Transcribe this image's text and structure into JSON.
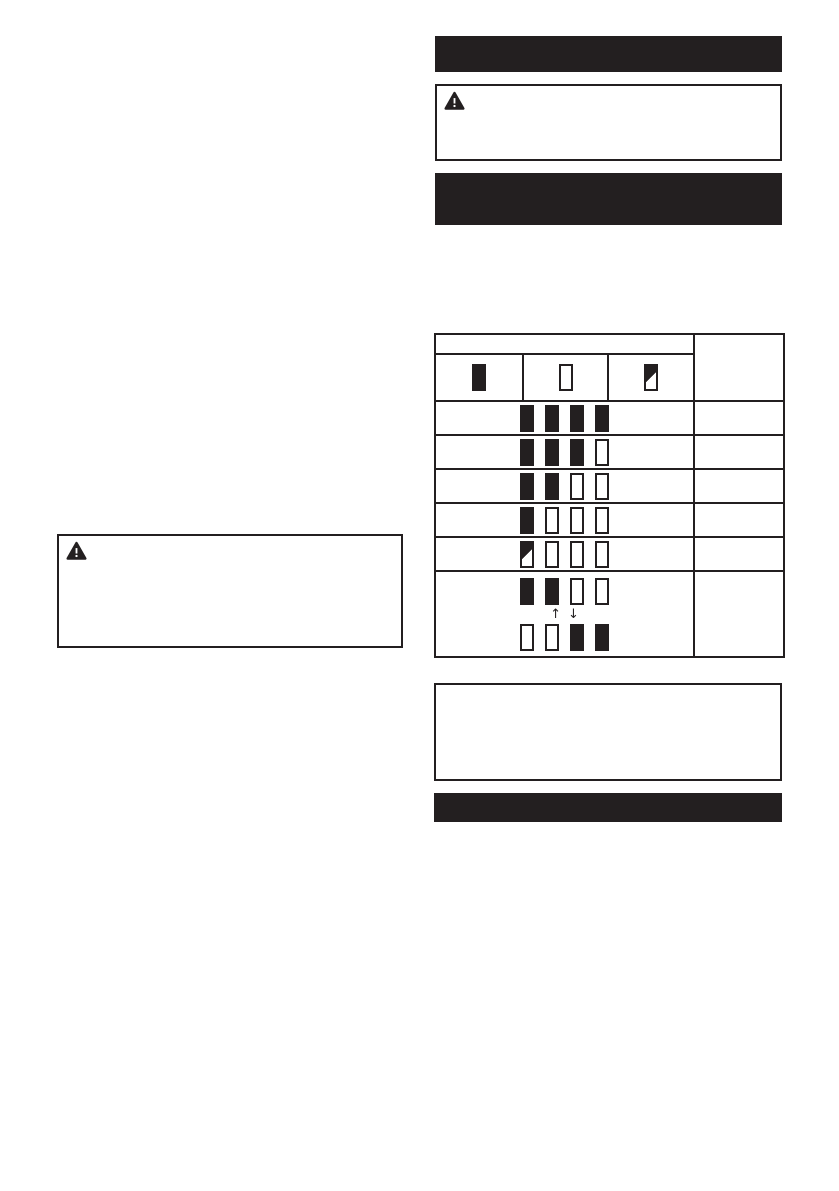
{
  "colors": {
    "ink": "#231f20",
    "paper": "#ffffff"
  },
  "sections": {
    "top_header_bar": {
      "visible_text": ""
    },
    "second_header_bar": {
      "visible_text": ""
    },
    "bottom_header_bar": {
      "visible_text": ""
    }
  },
  "warning_boxes": {
    "right": {
      "icon": "warning-triangle"
    },
    "left": {
      "icon": "warning-triangle"
    }
  },
  "note_box": {
    "visible_text": ""
  },
  "indicator_table": {
    "legend": [
      {
        "state": "lighted"
      },
      {
        "state": "off"
      },
      {
        "state": "blinking"
      }
    ],
    "rows": [
      {
        "type": "lamps",
        "lamps": [
          "lighted",
          "lighted",
          "lighted",
          "lighted"
        ]
      },
      {
        "type": "lamps",
        "lamps": [
          "lighted",
          "lighted",
          "lighted",
          "off"
        ]
      },
      {
        "type": "lamps",
        "lamps": [
          "lighted",
          "lighted",
          "off",
          "off"
        ]
      },
      {
        "type": "lamps",
        "lamps": [
          "lighted",
          "off",
          "off",
          "off"
        ]
      },
      {
        "type": "lamps",
        "lamps": [
          "blinking",
          "off",
          "off",
          "off"
        ]
      },
      {
        "type": "transition",
        "top": [
          "lighted",
          "lighted",
          "off",
          "off"
        ],
        "arrows": [
          "↑",
          "↓"
        ],
        "bottom": [
          "off",
          "off",
          "lighted",
          "lighted"
        ]
      }
    ]
  }
}
